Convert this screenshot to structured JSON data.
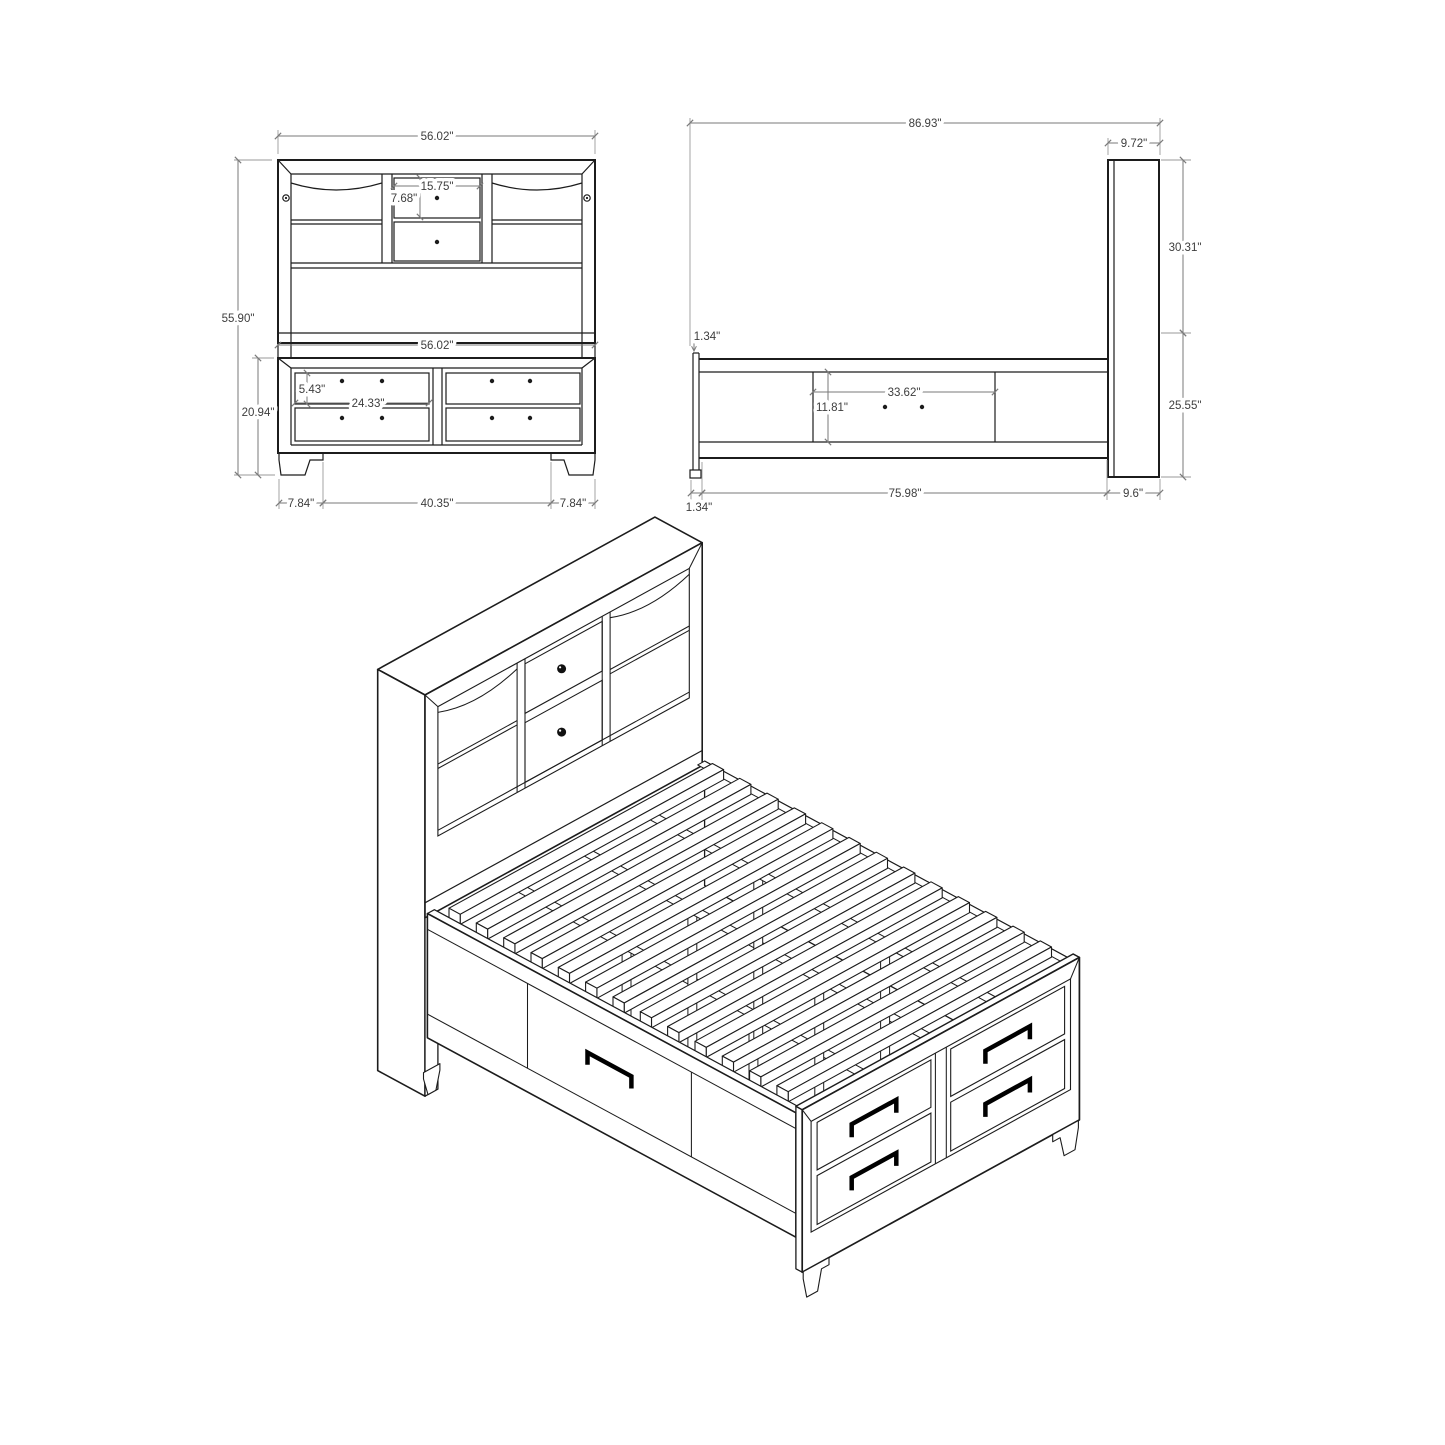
{
  "drawing": {
    "subject": "storage-bed-with-bookcase-headboard-technical-drawing",
    "colors": {
      "line": "#1c1c1c",
      "dim_line": "#7a7a7a",
      "dim_text": "#3d3d3d",
      "background": "#ffffff",
      "handle": "#000000"
    }
  },
  "front_view": {
    "width_top": "56.02\"",
    "center_opening_width": "15.75\"",
    "center_opening_height": "7.68\"",
    "overall_height": "55.90\"",
    "width_at_base": "56.02\"",
    "footboard_drawer_height": "5.43\"",
    "footboard_drawer_width": "24.33\"",
    "footboard_height": "20.94\"",
    "base_left_offset": "7.84\"",
    "base_center_span": "40.35\"",
    "base_right_offset": "7.84\""
  },
  "side_view": {
    "overall_length": "86.93\"",
    "headboard_depth": "9.72\"",
    "headboard_height_above_rail": "30.31\"",
    "rail_top_lip": "1.34\"",
    "side_drawer_width": "33.62\"",
    "side_drawer_height": "11.81\"",
    "footboard_side_height": "25.55\"",
    "rail_length": "75.98\"",
    "headboard_base_depth": "9.6\"",
    "rail_end_lip": "1.34\""
  }
}
